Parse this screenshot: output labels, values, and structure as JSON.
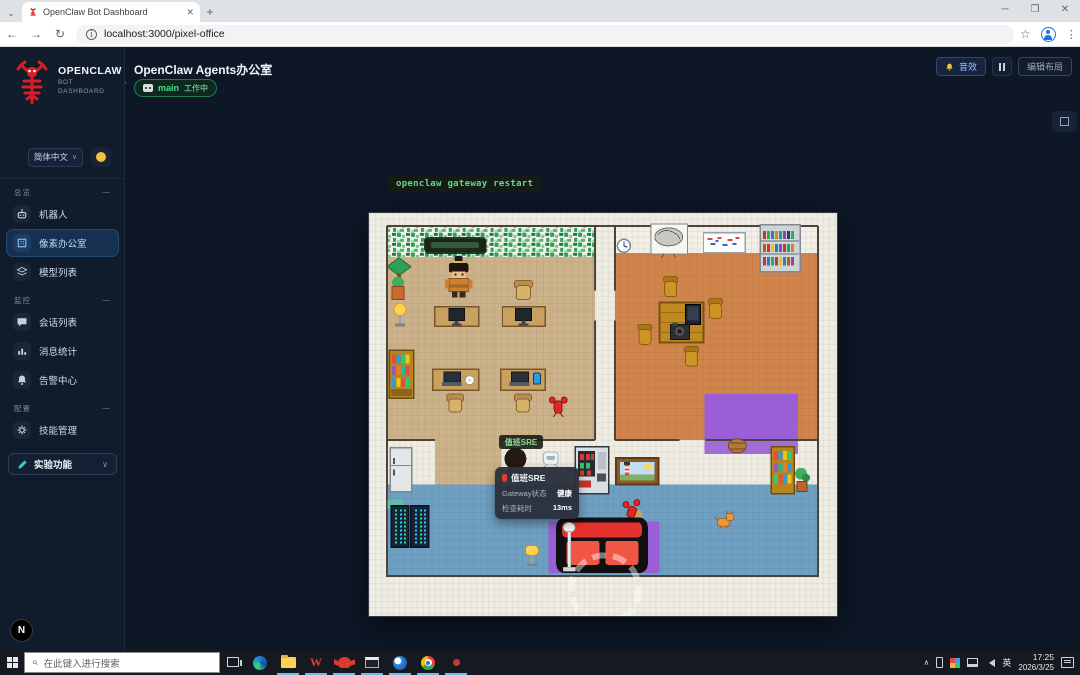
{
  "browser": {
    "tab_title": "OpenClaw Bot Dashboard",
    "url": "localhost:3000/pixel-office"
  },
  "sidebar": {
    "brand_name": "OPENCLAW",
    "brand_sub1": "BOT",
    "brand_sub2": "DASHBOARD",
    "language": "简体中文",
    "sections": [
      {
        "label": "总览",
        "items": [
          {
            "label": "机器人"
          },
          {
            "label": "像素办公室"
          },
          {
            "label": "模型列表"
          }
        ]
      },
      {
        "label": "监控",
        "items": [
          {
            "label": "会话列表"
          },
          {
            "label": "消息统计"
          },
          {
            "label": "告警中心"
          }
        ]
      },
      {
        "label": "配置",
        "items": [
          {
            "label": "技能管理"
          }
        ]
      }
    ],
    "experimental_label": "实验功能",
    "dev_badge": "N"
  },
  "header": {
    "title": "OpenClaw Agents办公室",
    "agent_name": "main",
    "agent_status": "工作中",
    "sound_button": "音效",
    "edit_layout_button": "编辑布局"
  },
  "office": {
    "command_bubble": "openclaw gateway restart",
    "sre_label": "值班SRE",
    "tooltip": {
      "title": "值班SRE",
      "row1_label": "Gateway状态",
      "row1_value": "健康",
      "row2_label": "检查耗时",
      "row2_value": "13ms"
    }
  },
  "taskbar": {
    "search_placeholder": "在此键入进行搜索",
    "input_lang": "英",
    "time": "17:25",
    "date": "2026/3/25"
  },
  "colors": {
    "accent_blue": "#3b82f6",
    "status_green": "#34d399",
    "bell_yellow": "#f5c33b",
    "lobster_red": "#d61f26",
    "sidebar_bg": "#101b2c",
    "main_bg": "#0d1726"
  }
}
